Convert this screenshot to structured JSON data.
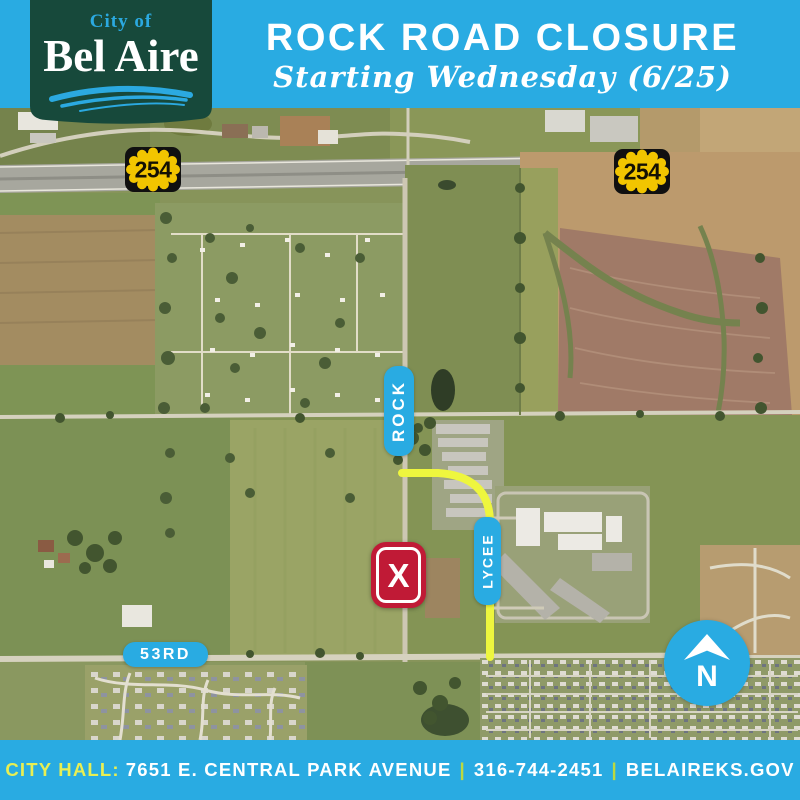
{
  "header": {
    "title": "ROCK ROAD CLOSURE",
    "subtitle": "Starting Wednesday (6/25)",
    "logo": {
      "line1": "City of",
      "line2": "Bel Aire"
    },
    "colors": {
      "background": "#29ABE2",
      "banner_green": "#17493B"
    }
  },
  "map": {
    "shields": [
      {
        "label": "254"
      },
      {
        "label": "254"
      }
    ],
    "road_labels": {
      "rock": "ROCK",
      "lycee": "LYCEE",
      "fifty_third": "53RD"
    },
    "closure_marker": {
      "glyph": "X",
      "color": "#C01A36"
    },
    "north_indicator": {
      "label": "N"
    },
    "detour_color": "#EEF63E",
    "label_color": "#29ABE2",
    "shield_yellow": "#F2C500"
  },
  "footer": {
    "prefix": "CITY HALL:",
    "address": "7651 E. CENTRAL PARK AVENUE",
    "phone": "316-744-2451",
    "website": "BELAIREKS.GOV",
    "separator": "|",
    "colors": {
      "background": "#29ABE2",
      "highlight": "#E8EF53"
    }
  }
}
